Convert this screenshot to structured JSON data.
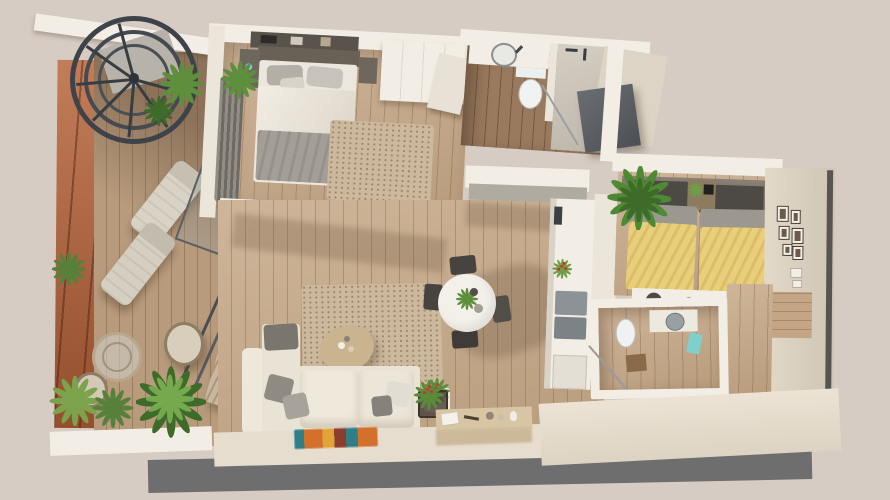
{
  "scene": {
    "title": "3D apartment floor plan — top-down dollhouse render",
    "view": "top-down 3d render",
    "has_text": false
  },
  "palette": {
    "bg": "#d6ccc4",
    "wallTop": "#f3eee5",
    "wallLight": "#ece6da",
    "wallMid": "#ddd4c5",
    "wallFaceA": "#e3d9c9",
    "wallFaceB": "#cfc5b5",
    "shadowBand": "#6e6e6e",
    "edgeDark": "#57554f",
    "woodFloor": "#c8ab8b",
    "woodDark": "#9a7a5e",
    "deck": "#b89b7d",
    "terracotta": "#ad5c36",
    "stairMetal": "#3e4349",
    "sofa": "#e9e3d5",
    "cushionGray": "#8f8a82",
    "cushionLight": "#a8a39a",
    "duvet": "#ece7de",
    "blanketGray": "#a39e97",
    "headboard": "#6a6156",
    "darkHeadboard": "#4d4944",
    "rugBeige": "#ccb99d",
    "yellowBed": "#e9cf7b",
    "pillowBand": "#9d988f",
    "plantGreen": "#5d8f3c",
    "plantDark": "#3f6b2a",
    "plantLight": "#7ca24b",
    "towelTeal": "#7fd0cb",
    "applianceGray": "#8d9296",
    "counterGray": "#b0aba0",
    "consoleTan": "#d8c5a3",
    "accentRed": "#c4392f",
    "glass": "rgba(150,160,158,0.3)",
    "glassFrame": "#596063",
    "rug1": "#2e7f86",
    "rug2": "#d2702c",
    "rug3": "#e0a33a",
    "rug4": "#8c3d2e"
  },
  "rooms": [
    {
      "id": "terrace",
      "label": "Terrace",
      "features": [
        "spiral staircase",
        "two sun loungers",
        "bistro table with two chairs",
        "striped outdoor bench",
        "terracotta feature wall",
        "wood deck",
        "potted plants",
        "glass balustrade"
      ]
    },
    {
      "id": "master-bedroom",
      "label": "Master Bedroom",
      "features": [
        "double bed with gray foot blanket",
        "headboard",
        "two nightstands",
        "wall shelf",
        "wardrobe",
        "shaggy rug",
        "curtain",
        "sliding glass door",
        "sideboard with plants"
      ]
    },
    {
      "id": "bathroom-1",
      "label": "Bathroom 1",
      "features": [
        "vanity with round sink",
        "toilet",
        "walk-in shower",
        "dark closet"
      ]
    },
    {
      "id": "kitchen",
      "label": "Kitchen",
      "features": [
        "L-shaped white counter",
        "gray appliances",
        "flower pot",
        "lower cabinet"
      ]
    },
    {
      "id": "living-dining",
      "label": "Living / Dining Room",
      "features": [
        "corner sofa with pillows",
        "organic coffee table",
        "beige area rug",
        "multicolor runner rug",
        "round dining table with plant centerpiece",
        "four dark chairs",
        "console with decor",
        "flower basket"
      ]
    },
    {
      "id": "bedroom-2",
      "label": "Bedroom 2",
      "features": [
        "two twin beds with yellow covers",
        "shared nightstand with plant",
        "palm plant",
        "gallery wall frames",
        "desk with stool",
        "wood niche panel"
      ]
    },
    {
      "id": "bathroom-2",
      "label": "Bathroom 2",
      "features": [
        "vanity sink",
        "toilet",
        "shower with glass",
        "teal towel",
        "bath mat"
      ]
    },
    {
      "id": "hallway",
      "label": "Hallway",
      "features": [
        "wood floor"
      ]
    }
  ]
}
